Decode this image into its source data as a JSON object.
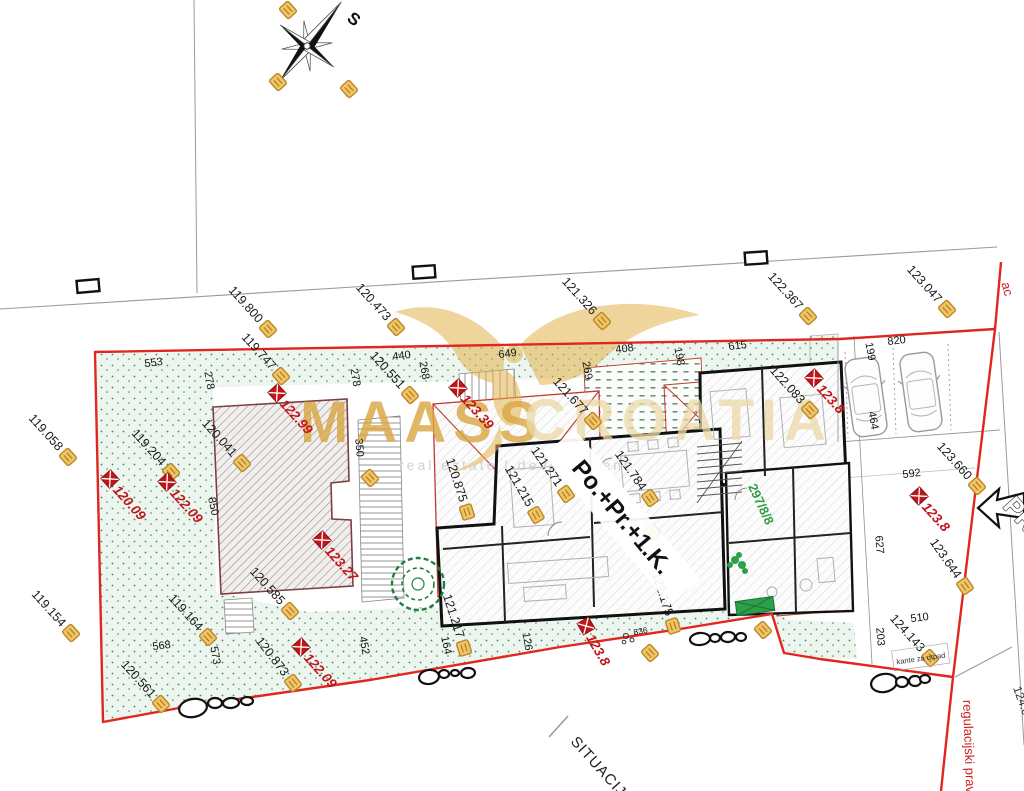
{
  "meta": {
    "compass_north": "S",
    "title": "SITUACIJA"
  },
  "watermark": {
    "maass": "MAASS",
    "croatia": "CROATIA",
    "tagline": "real estate | development"
  },
  "labels": {
    "building": "Po.+Pr.+1.K.",
    "parcel": "297/8/8",
    "street_suffix": "ac",
    "regulation": "regulacijski pravac",
    "trash": "kante za otpad",
    "access": "PR",
    "edge_elevation": "124.05"
  },
  "colors": {
    "boundary_red": "#e0261f",
    "marker_red": "#c1161a",
    "flag_fill": "#f2c464",
    "flag_border": "#b8872c",
    "grass_dot": "#47855f",
    "watermark_gold": "#d9a642"
  },
  "elevation_flags": [
    {
      "x": 268,
      "y": 329,
      "rot": 48,
      "label": "119.800"
    },
    {
      "x": 281,
      "y": 376,
      "rot": 48,
      "label": "119.747"
    },
    {
      "x": 396,
      "y": 327,
      "rot": 48,
      "label": "120.473"
    },
    {
      "x": 410,
      "y": 395,
      "rot": 48,
      "label": "120.551"
    },
    {
      "x": 602,
      "y": 321,
      "rot": 48,
      "label": "121.326"
    },
    {
      "x": 593,
      "y": 421,
      "rot": 48,
      "label": "121.677"
    },
    {
      "x": 808,
      "y": 316,
      "rot": 48,
      "label": "122.367"
    },
    {
      "x": 810,
      "y": 410,
      "rot": 48,
      "label": "122.083"
    },
    {
      "x": 947,
      "y": 309,
      "rot": 48,
      "label": "123.047"
    },
    {
      "x": 68,
      "y": 457,
      "rot": 48,
      "label": "119.058"
    },
    {
      "x": 71,
      "y": 633,
      "rot": 48,
      "label": "119.154"
    },
    {
      "x": 171,
      "y": 472,
      "rot": 48,
      "label": "119.204"
    },
    {
      "x": 242,
      "y": 463,
      "rot": 48,
      "label": "120.041"
    },
    {
      "x": 290,
      "y": 611,
      "rot": 48,
      "label": "120.585"
    },
    {
      "x": 208,
      "y": 637,
      "rot": 48,
      "label": "119.164"
    },
    {
      "x": 161,
      "y": 704,
      "rot": 48,
      "label": "120.561"
    },
    {
      "x": 293,
      "y": 683,
      "rot": 52,
      "label": "120.873"
    },
    {
      "x": 467,
      "y": 512,
      "rot": 72,
      "label": "120.875"
    },
    {
      "x": 536,
      "y": 515,
      "rot": 60,
      "label": "121.215"
    },
    {
      "x": 566,
      "y": 494,
      "rot": 55,
      "label": "121.271"
    },
    {
      "x": 650,
      "y": 498,
      "rot": 55,
      "label": "121.784"
    },
    {
      "x": 673,
      "y": 626,
      "rot": 72,
      "label": "122.175"
    },
    {
      "x": 977,
      "y": 486,
      "rot": 48,
      "label": "123.660"
    },
    {
      "x": 965,
      "y": 586,
      "rot": 55,
      "label": "123.644"
    },
    {
      "x": 930,
      "y": 658,
      "rot": 48,
      "label": "124.143"
    },
    {
      "x": 464,
      "y": 648,
      "rot": 72,
      "label": "121.217"
    },
    {
      "x": 288,
      "y": 10,
      "rot": 48,
      "label": ""
    },
    {
      "x": 278,
      "y": 82,
      "rot": 48,
      "label": ""
    },
    {
      "x": 349,
      "y": 89,
      "rot": 48,
      "label": ""
    },
    {
      "x": 763,
      "y": 630,
      "rot": 48,
      "label": ""
    },
    {
      "x": 650,
      "y": 653,
      "rot": 48,
      "label": ""
    },
    {
      "x": 652,
      "y": 532,
      "rot": 48,
      "label": ""
    },
    {
      "x": 370,
      "y": 478,
      "rot": 48,
      "label": ""
    }
  ],
  "spot_heights": [
    {
      "x": 110,
      "y": 479,
      "rot": 48,
      "label": "120.09"
    },
    {
      "x": 167,
      "y": 482,
      "rot": 48,
      "label": "122.09"
    },
    {
      "x": 301,
      "y": 647,
      "rot": 48,
      "label": "122.09"
    },
    {
      "x": 322,
      "y": 540,
      "rot": 48,
      "label": "123.27"
    },
    {
      "x": 458,
      "y": 388,
      "rot": 48,
      "label": "123.39"
    },
    {
      "x": 277,
      "y": 393,
      "rot": 48,
      "label": "122.99"
    },
    {
      "x": 814,
      "y": 378,
      "rot": 48,
      "label": "123.8"
    },
    {
      "x": 919,
      "y": 496,
      "rot": 48,
      "label": "123.8"
    },
    {
      "x": 586,
      "y": 626,
      "rot": 60,
      "label": "123.8"
    }
  ],
  "dimensions": [
    {
      "t": "553",
      "x": 154,
      "y": 366,
      "rot": -7
    },
    {
      "t": "278",
      "x": 206,
      "y": 381,
      "rot": 80
    },
    {
      "t": "278",
      "x": 352,
      "y": 378,
      "rot": 80
    },
    {
      "t": "440",
      "x": 402,
      "y": 359,
      "rot": -7
    },
    {
      "t": "268",
      "x": 421,
      "y": 371,
      "rot": 80
    },
    {
      "t": "350",
      "x": 356,
      "y": 448,
      "rot": 85
    },
    {
      "t": "649",
      "x": 508,
      "y": 357,
      "rot": -7
    },
    {
      "t": "408",
      "x": 625,
      "y": 352,
      "rot": -7
    },
    {
      "t": "198",
      "x": 676,
      "y": 357,
      "rot": 80
    },
    {
      "t": "269",
      "x": 584,
      "y": 371,
      "rot": 80
    },
    {
      "t": "615",
      "x": 738,
      "y": 349,
      "rot": -7
    },
    {
      "t": "199",
      "x": 867,
      "y": 352,
      "rot": 80
    },
    {
      "t": "820",
      "x": 897,
      "y": 344,
      "rot": -7
    },
    {
      "t": "464",
      "x": 870,
      "y": 421,
      "rot": 80
    },
    {
      "t": "850",
      "x": 210,
      "y": 507,
      "rot": 78
    },
    {
      "t": "592",
      "x": 912,
      "y": 477,
      "rot": -7
    },
    {
      "t": "627",
      "x": 876,
      "y": 545,
      "rot": 85
    },
    {
      "t": "203",
      "x": 877,
      "y": 637,
      "rot": 85
    },
    {
      "t": "510",
      "x": 920,
      "y": 621,
      "rot": -7
    },
    {
      "t": "568",
      "x": 162,
      "y": 649,
      "rot": -7
    },
    {
      "t": "573",
      "x": 212,
      "y": 656,
      "rot": 80
    },
    {
      "t": "452",
      "x": 361,
      "y": 646,
      "rot": 80
    },
    {
      "t": "126",
      "x": 524,
      "y": 642,
      "rot": 80
    },
    {
      "t": "164",
      "x": 443,
      "y": 646,
      "rot": 78
    },
    {
      "t": "836",
      "x": 641,
      "y": 634,
      "rot": -10,
      "small": true
    }
  ],
  "rocks": [
    {
      "cx": 193,
      "cy": 708,
      "rx": 14,
      "ry": 9,
      "rot": -10
    },
    {
      "cx": 215,
      "cy": 703,
      "rx": 7,
      "ry": 5,
      "rot": 0
    },
    {
      "cx": 231,
      "cy": 703,
      "rx": 8,
      "ry": 5,
      "rot": -5
    },
    {
      "cx": 247,
      "cy": 701,
      "rx": 6,
      "ry": 4,
      "rot": 0
    },
    {
      "cx": 429,
      "cy": 677,
      "rx": 10,
      "ry": 7,
      "rot": -8
    },
    {
      "cx": 444,
      "cy": 674,
      "rx": 5,
      "ry": 4,
      "rot": 0
    },
    {
      "cx": 455,
      "cy": 673,
      "rx": 4,
      "ry": 3,
      "rot": 0
    },
    {
      "cx": 468,
      "cy": 673,
      "rx": 7,
      "ry": 5,
      "rot": -5
    },
    {
      "cx": 700,
      "cy": 639,
      "rx": 10,
      "ry": 6,
      "rot": -5
    },
    {
      "cx": 715,
      "cy": 638,
      "rx": 5,
      "ry": 4,
      "rot": 0
    },
    {
      "cx": 728,
      "cy": 637,
      "rx": 7,
      "ry": 5,
      "rot": -5
    },
    {
      "cx": 741,
      "cy": 637,
      "rx": 5,
      "ry": 4,
      "rot": 0
    },
    {
      "cx": 884,
      "cy": 683,
      "rx": 13,
      "ry": 9,
      "rot": -10
    },
    {
      "cx": 902,
      "cy": 682,
      "rx": 6,
      "ry": 5,
      "rot": 0
    },
    {
      "cx": 915,
      "cy": 681,
      "rx": 6,
      "ry": 5,
      "rot": 0
    },
    {
      "cx": 925,
      "cy": 679,
      "rx": 5,
      "ry": 4,
      "rot": 0
    }
  ],
  "cars": [
    {
      "cx": 866,
      "cy": 397,
      "rot": -8
    },
    {
      "cx": 921,
      "cy": 392,
      "rot": -8
    }
  ]
}
